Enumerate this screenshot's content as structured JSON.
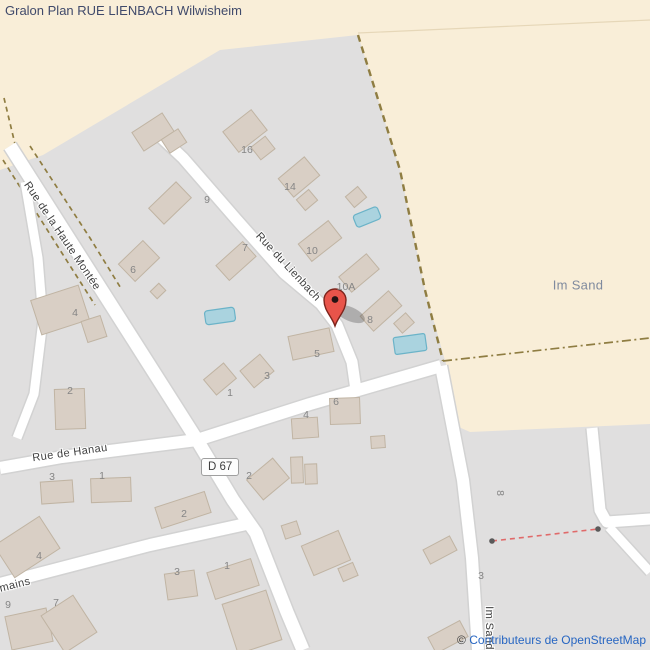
{
  "title": "Gralon Plan RUE LIENBACH Wilwisheim",
  "attribution": {
    "copyright": "©",
    "link_text": "Contributeurs de OpenStreetMap"
  },
  "road_badge": {
    "label": "D 67"
  },
  "place_label": {
    "text": "Im Sand",
    "x": 578,
    "y": 285
  },
  "marker": {
    "name": "map-marker",
    "x": 335,
    "y": 326
  },
  "street_labels": [
    {
      "text": "Rue de la Haute Montée",
      "x": 62,
      "y": 236,
      "rot": 56
    },
    {
      "text": "Rue du Lienbach",
      "x": 288,
      "y": 267,
      "rot": 47
    },
    {
      "text": "Rue de Hanau",
      "x": 70,
      "y": 453,
      "rot": -8
    },
    {
      "text": "mains",
      "x": 15,
      "y": 585,
      "rot": -14
    },
    {
      "text": "Im Sand",
      "x": 489,
      "y": 628,
      "rot": 90
    }
  ],
  "house_numbers": [
    {
      "text": "16",
      "x": 247,
      "y": 150,
      "rot": 0
    },
    {
      "text": "14",
      "x": 290,
      "y": 187,
      "rot": 0
    },
    {
      "text": "9",
      "x": 207,
      "y": 200,
      "rot": 0
    },
    {
      "text": "7",
      "x": 245,
      "y": 248,
      "rot": 0
    },
    {
      "text": "6",
      "x": 133,
      "y": 270,
      "rot": 0
    },
    {
      "text": "10",
      "x": 312,
      "y": 251,
      "rot": 0
    },
    {
      "text": "10A",
      "x": 346,
      "y": 287,
      "rot": 0
    },
    {
      "text": "8",
      "x": 370,
      "y": 320,
      "rot": 0
    },
    {
      "text": "5",
      "x": 317,
      "y": 354,
      "rot": 0
    },
    {
      "text": "4",
      "x": 75,
      "y": 313,
      "rot": 0
    },
    {
      "text": "3",
      "x": 267,
      "y": 376,
      "rot": 0
    },
    {
      "text": "1",
      "x": 230,
      "y": 393,
      "rot": 0
    },
    {
      "text": "2",
      "x": 70,
      "y": 391,
      "rot": 0
    },
    {
      "text": "6",
      "x": 336,
      "y": 402,
      "rot": 0
    },
    {
      "text": "4",
      "x": 306,
      "y": 415,
      "rot": 0
    },
    {
      "text": "3",
      "x": 52,
      "y": 477,
      "rot": 0
    },
    {
      "text": "1",
      "x": 102,
      "y": 476,
      "rot": 0
    },
    {
      "text": "2",
      "x": 249,
      "y": 476,
      "rot": 0
    },
    {
      "text": "2",
      "x": 184,
      "y": 514,
      "rot": 0
    },
    {
      "text": "3",
      "x": 177,
      "y": 572,
      "rot": 0
    },
    {
      "text": "1",
      "x": 227,
      "y": 566,
      "rot": 0
    },
    {
      "text": "8",
      "x": 500,
      "y": 493,
      "rot": 90
    },
    {
      "text": "3",
      "x": 481,
      "y": 576,
      "rot": 0
    },
    {
      "text": "4",
      "x": 39,
      "y": 556,
      "rot": 0
    },
    {
      "text": "9",
      "x": 8,
      "y": 605,
      "rot": 0
    },
    {
      "text": "7",
      "x": 56,
      "y": 603,
      "rot": 0
    }
  ],
  "colors": {
    "farmland": "#f9eed8",
    "residential": "#e0dfdf",
    "building": "#d9cfc5",
    "building_border": "#c0b4a3",
    "road": "#ffffff",
    "road_casing": "#d2d2d2",
    "water": "#aad3df",
    "path_dash": "#8f7d42",
    "marker": "#e8544a",
    "title": "#404a6b",
    "link": "#2766c2",
    "red_dash": "#e06a6a"
  }
}
